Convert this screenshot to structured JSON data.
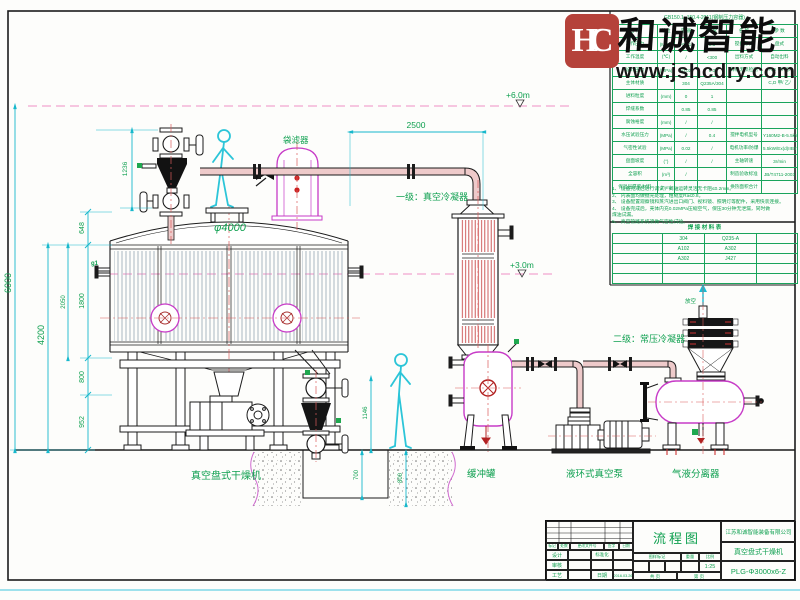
{
  "logo": {
    "monogram": "HC",
    "brand": "和诚智能",
    "website": "www.jshcdry.com"
  },
  "labels": {
    "bag_filter": "袋滤器",
    "condenser1": "一级：真空冷凝器",
    "condenser2": "二级：常压冷凝器",
    "dryer": "真空盘式干燥机",
    "buffer_tank": "缓冲罐",
    "vacuum_pump": "液环式真空泵",
    "separator": "气液分离器",
    "vent": "放空",
    "nozzle_g1": "g1",
    "diameter": "φ4000"
  },
  "dims": {
    "h6000": "6000",
    "h4200": "4200",
    "h2050": "2050",
    "h648": "648",
    "h1800": "1800",
    "h800": "800",
    "h952": "952",
    "h1236": "1236",
    "w2500": "2500",
    "d1146": "1146",
    "pit700": "700",
    "pit800": "800"
  },
  "elevations": {
    "top": "+6.0m",
    "mid": "+3.0m"
  },
  "spec_table": {
    "standard": "GB150.1~150.4-2011(钢制压力容器)",
    "rows": [
      [
        "名 称",
        "单位",
        "容 器",
        "夹 套",
        "名  称",
        "参  数"
      ],
      [
        "工作压力",
        "(MPa)",
        "-0.01",
        "0.3",
        "搅拌形式",
        "盘式"
      ],
      [
        "工作温度",
        "(℃)",
        "/",
        "<300",
        "出料方式",
        "自动出料"
      ],
      [
        "设计压力",
        "(MPa)",
        "-0.02",
        "0.3",
        "焊缝无损检测",
        "A,B 甲/ 乙/"
      ],
      [
        "主体材质",
        "",
        "304",
        "Q235A/304",
        "",
        "C,D 甲/ 乙/"
      ],
      [
        "进料粒度",
        "(mm)",
        "0",
        "1",
        "",
        ""
      ],
      [
        "焊缝系数",
        "",
        "0.85",
        "0.85",
        "",
        ""
      ],
      [
        "腐蚀裕度",
        "(mm)",
        "/",
        "/",
        "",
        ""
      ],
      [
        "水压试验压力",
        "(MPa)",
        "/",
        "0.4",
        "搅拌电机型号",
        "Y160M2-B-5.5kW"
      ],
      [
        "气密性试验",
        "(MPa)",
        "0.02",
        "/",
        "电机功率/防爆",
        "5.5kW/Ex(d)IIBT4"
      ],
      [
        "盘面坡度",
        "(°)",
        "/",
        "/",
        "主轴转速",
        "3r/min"
      ],
      [
        "全容积",
        "(m³)",
        "/",
        "",
        "制造验收标准",
        "JB/T4711-2003"
      ],
      [
        "保温层厚度/材料",
        "(mm)",
        "/",
        "",
        "换热面积合计",
        ""
      ]
    ]
  },
  "notes": {
    "items": [
      "1、 设备完成后进行调试，阀轴运转灵活无卡阻≤0.2mm。",
      "2、 内表面均做抛光处理，粗糙度Ra≤0.8。",
      "3、 设备配置观察镜和蒸汽进出口阀门、视料镜、照明灯等配件，采用快装连接。",
      "4、 设备完成后，壳体内充0.02MPa压缩空气，保压30分钟无泄漏，同时做",
      "煤油试漏。",
      "5、 真空管路系统须做气密性试验。"
    ]
  },
  "weld_table": {
    "title": "焊 接 材 料 表",
    "rows": [
      [
        "",
        "304",
        "Q235-A",
        ""
      ],
      [
        "",
        "A102",
        "A302",
        ""
      ],
      [
        "",
        "A302",
        "J427",
        ""
      ],
      [
        "",
        "",
        "",
        ""
      ],
      [
        "",
        "",
        "",
        ""
      ]
    ]
  },
  "titleblock": {
    "doc_type": "流程图",
    "company": "江苏和诚智能装备有限公司",
    "product": "真空盘式干燥机",
    "model": "PLG-Φ3000x6-Z",
    "rev_headers": [
      "标记",
      "处数",
      "更改文件号",
      "签字",
      "日期"
    ],
    "design": "设计",
    "check": "审核",
    "process": "工艺",
    "standardize": "标准化",
    "date_label": "日期",
    "date": "2016.03.26",
    "mark_label": "图样标记",
    "weight_label": "重量",
    "scale_label": "比例",
    "scale": "1:25",
    "pages_total": "共  页",
    "pages_page": "第  页"
  },
  "colors": {
    "annotation_green": "#0fa050",
    "dimension_cyan": "#17b8cc",
    "elevation_magenta": "#ee8fc4",
    "vessel_magenta": "#c73bc7",
    "centerline_red": "#d95b5b",
    "pipe_fill": "#eecaca",
    "logo_red": "#b5423a",
    "worker_cyan": "#2cc5d8",
    "line_black": "#1b1b1b"
  }
}
